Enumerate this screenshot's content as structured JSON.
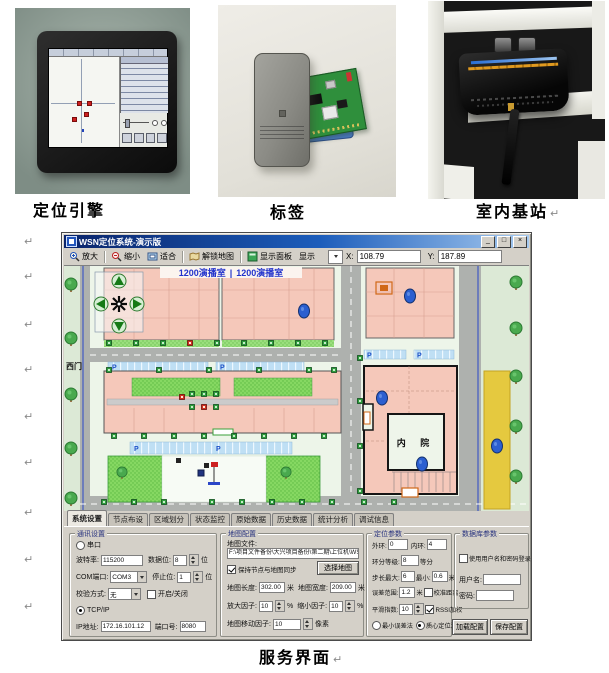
{
  "page": {
    "captions": {
      "photo1": "定位引擎",
      "photo2": "标签",
      "photo3": "室内基站",
      "screenshot": "服务界面"
    },
    "pilcrow": "↵"
  },
  "window": {
    "title": "WSN定位系统-演示版",
    "controls": {
      "minimize": "_",
      "maximize": "□",
      "close": "×"
    },
    "toolbar": {
      "zoom_in": "放大",
      "zoom_out": "缩小",
      "fit": "适合",
      "unlock_map": "解锁地图",
      "show_panel": "显示面板",
      "show": "显示",
      "x_label": "X:",
      "x_value": "108.79",
      "y_label": "Y:",
      "y_value": "187.89"
    },
    "map": {
      "studio_left": "1200演播室",
      "divider": "|",
      "studio_right": "1200演播室",
      "west_gate": "西门",
      "inner_yard": "内 院",
      "parking": "P"
    },
    "tabs": [
      "系统设置",
      "节点布设",
      "区域划分",
      "状态监控",
      "原始数据",
      "历史数据",
      "统计分析",
      "调试信息"
    ],
    "units": {
      "bit": "位",
      "m": "米",
      "pct": "%",
      "px": "像素",
      "div": "等分"
    },
    "comm": {
      "title": "通讯设置",
      "serial": "串口",
      "baud_label": "波特率:",
      "baud": "115200",
      "databits_label": "数据位:",
      "databits": "8",
      "com_label": "COM端口:",
      "com": "COM3",
      "stopbits_label": "停止位:",
      "stopbits": "1",
      "parity_label": "校验方式:",
      "parity": "无",
      "toggle": "开启/关闭",
      "tcpip": "TCP/IP",
      "ip_label": "IP地址:",
      "ip": "172.16.101.12",
      "port_label": "端口号:",
      "port": "8080"
    },
    "mapcfg": {
      "title": "地图配置",
      "file_label": "地图文件:",
      "file": "F:\\项目文件备份\\大兴项目备份\\第二期\\上位机\\WSN",
      "sync": "保持节点与地图同步",
      "choose": "选择地图",
      "len_label": "地图长度:",
      "len": "302.00",
      "wid_label": "地图宽度:",
      "wid": "209.00",
      "zin_label": "放大因子:",
      "zin": "10",
      "zout_label": "缩小因子:",
      "zout": "10",
      "move_label": "地图移动因子:",
      "move": "10"
    },
    "loc": {
      "title": "定位参数",
      "outer_label": "外环:",
      "outer": "0",
      "inner_label": "内环:",
      "inner": "4",
      "ring_label": "环分等级:",
      "ring": "8",
      "stepmax_label": "步长最大:",
      "stepmax": "6",
      "stepmin_label": "最小:",
      "stepmin": "0.6",
      "err_label": "误差范围:",
      "err": "1.2",
      "calib": "校准距离",
      "smooth_label": "平滑指数:",
      "smooth": "10",
      "rssi": "RSSI加权",
      "minerr": "最小误差法",
      "centroid": "质心定位法"
    },
    "db": {
      "title": "数据库参数",
      "uselogin": "使用用户名和密码登录",
      "user_label": "用户名:",
      "pwd_label": "密码:",
      "load": "加载配置",
      "save": "保存配置"
    },
    "colors": {
      "titlebar": "#0a246a",
      "chrome": "#d4d0c8",
      "building": "#f5c8ba",
      "lawn": "#86d862",
      "road": "#aeb1ae",
      "marker": "#2b5fd0",
      "parking": "#bfdff4",
      "highlight_strip": "#e5c93f"
    }
  }
}
